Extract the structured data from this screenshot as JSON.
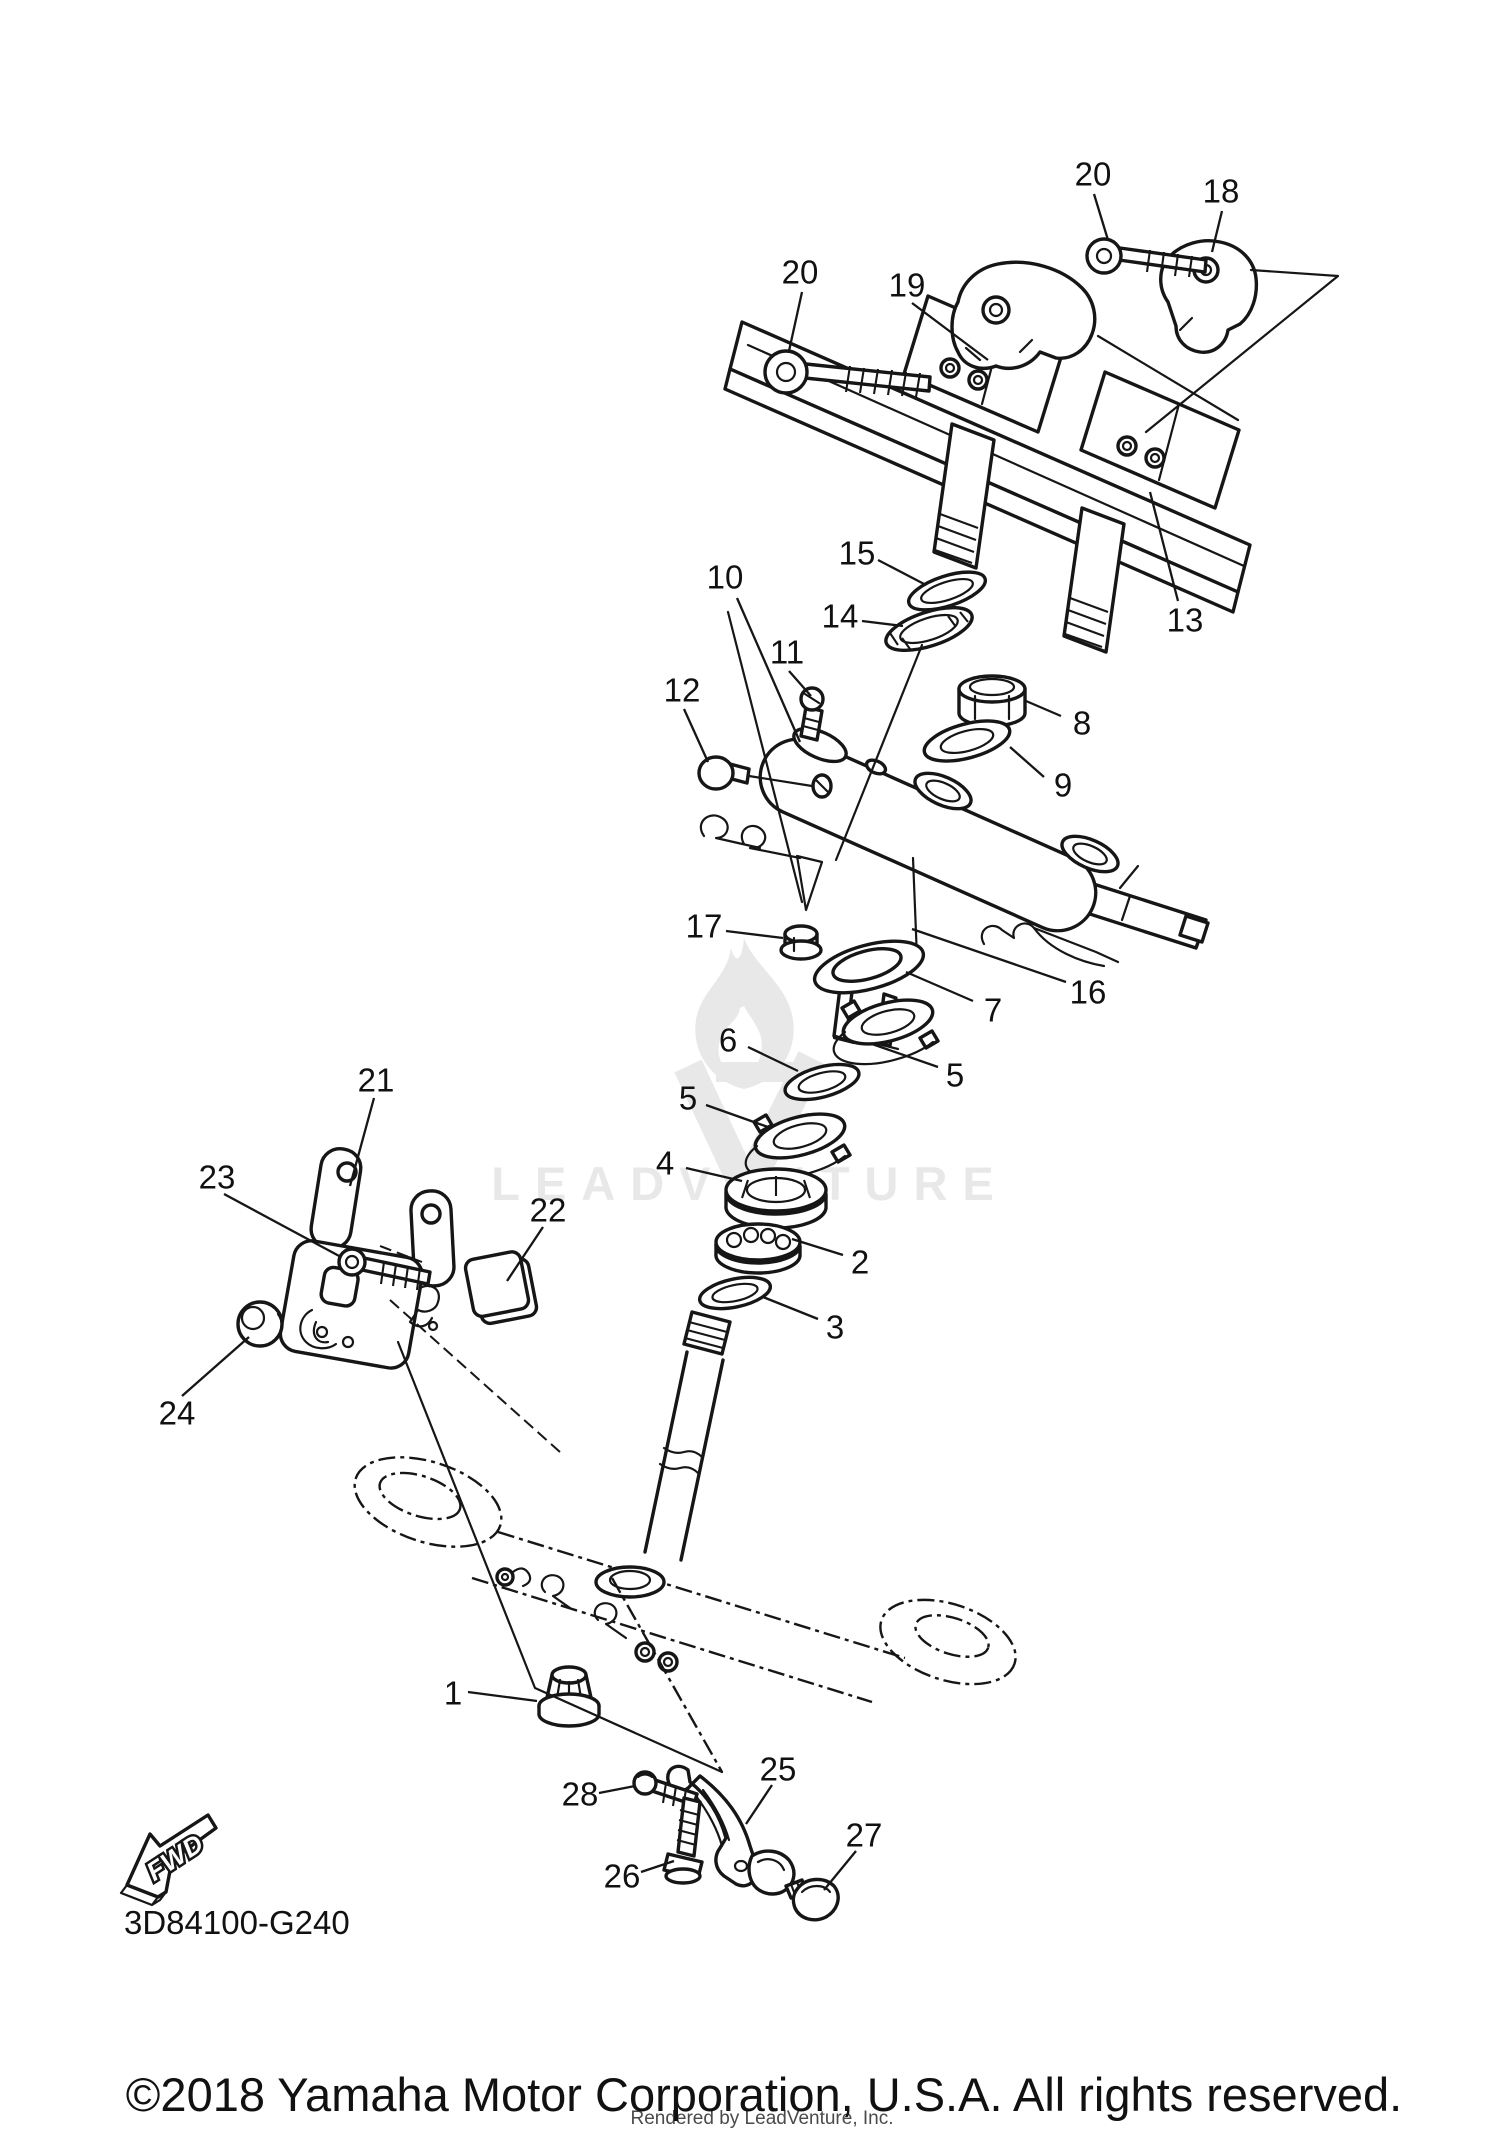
{
  "page": {
    "background": "#ffffff",
    "ink_color": "#161616"
  },
  "diagram": {
    "drawing_number": "3D84100-G240",
    "fwd_label": "FWD",
    "watermark": {
      "text": "LEADVENTURE",
      "color": "#e8e8e8"
    },
    "callouts": [
      {
        "label": "20"
      },
      {
        "label": "19"
      },
      {
        "label": "20"
      },
      {
        "label": "18"
      },
      {
        "label": "13"
      },
      {
        "label": "15"
      },
      {
        "label": "14"
      },
      {
        "label": "10"
      },
      {
        "label": "11"
      },
      {
        "label": "12"
      },
      {
        "label": "8"
      },
      {
        "label": "9"
      },
      {
        "label": "17"
      },
      {
        "label": "7"
      },
      {
        "label": "16"
      },
      {
        "label": "6"
      },
      {
        "label": "5"
      },
      {
        "label": "5"
      },
      {
        "label": "4"
      },
      {
        "label": "2"
      },
      {
        "label": "3"
      },
      {
        "label": "21"
      },
      {
        "label": "23"
      },
      {
        "label": "22"
      },
      {
        "label": "24"
      },
      {
        "label": "1"
      },
      {
        "label": "28"
      },
      {
        "label": "26"
      },
      {
        "label": "25"
      },
      {
        "label": "27"
      }
    ],
    "footer": {
      "copyright": "©2018 Yamaha Motor Corporation, U.S.A. All rights reserved.",
      "rendered_by": "Rendered by LeadVenture, Inc."
    }
  }
}
